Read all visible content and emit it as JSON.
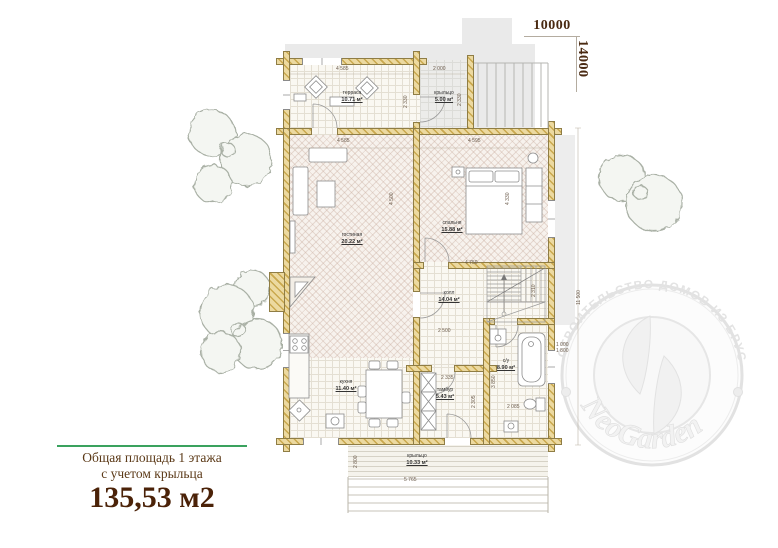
{
  "site": {
    "width_label": "10000",
    "height_label": "14000"
  },
  "summary": {
    "line1": "Общая площадь 1 этажа",
    "line2": "с учетом крыльца",
    "total": "135,53 м2",
    "accent_color": "#3aa25e",
    "text_color": "#5c3a18"
  },
  "watermark": {
    "arc_text": "СТРОИТЕЛЬСТВО ДОМОВ ИЗ БРУСА",
    "brand": "NeoGarden"
  },
  "plan": {
    "rooms": [
      {
        "name": "терраса",
        "area": "10.71 м²"
      },
      {
        "name": "крыльцо",
        "area": "5.00 м²"
      },
      {
        "name": "гостиная",
        "area": "20.22 м²"
      },
      {
        "name": "спальня",
        "area": "15.88 м²"
      },
      {
        "name": "холл",
        "area": "14.04 м²"
      },
      {
        "name": "с/у",
        "area": "8.90 м²"
      },
      {
        "name": "кухня",
        "area": "11.40 м²"
      },
      {
        "name": "тамбур",
        "area": "5.43 м²"
      },
      {
        "name": "крыльцо",
        "area": "10.33 м²"
      }
    ],
    "dimensions": [
      "4 585",
      "2 000",
      "2 330",
      "2 330",
      "4 585",
      "4 595",
      "4 500",
      "4 330",
      "4 750",
      "2 310",
      "2 500",
      "2 335",
      "2 305",
      "3 850",
      "2 085",
      "2 800",
      "5 765",
      "11 500",
      "1 000",
      "1 800"
    ],
    "wall_color": "#ecd9a0"
  }
}
